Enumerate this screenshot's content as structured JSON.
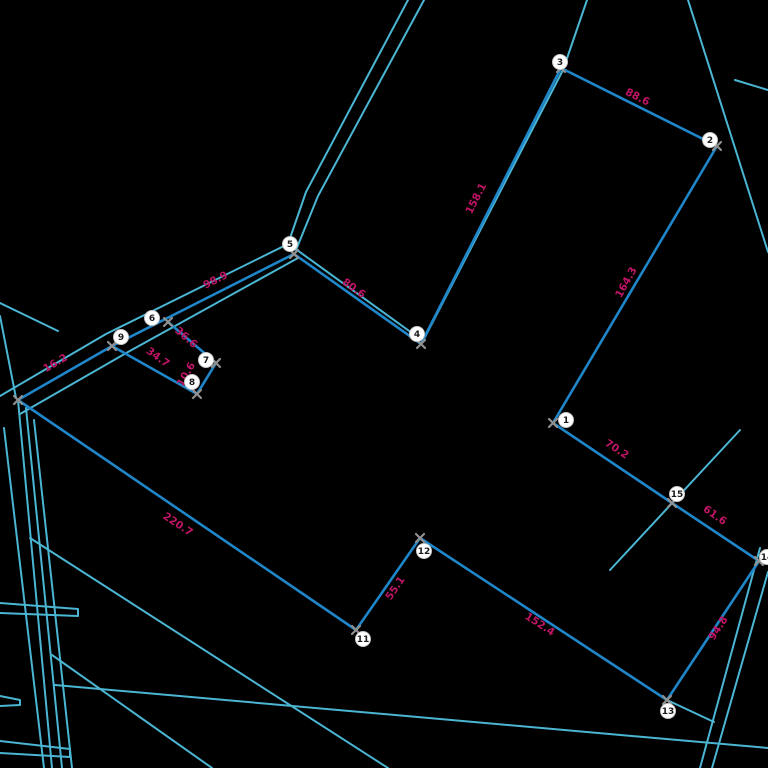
{
  "canvas": {
    "width": 768,
    "height": 768,
    "background": "#000000"
  },
  "style": {
    "boundary_color": "#1f86c9",
    "road_color": "#4bb6d3",
    "label_color": "#c01566",
    "marker_color": "#909090",
    "point_fill": "#ffffff",
    "point_stroke": "#c8c8c8",
    "point_text": "#1a1a1a",
    "boundary_width": 2.6,
    "road_width": 2
  },
  "points": [
    {
      "n": "1",
      "x": 566,
      "y": 420
    },
    {
      "n": "2",
      "x": 710,
      "y": 140
    },
    {
      "n": "3",
      "x": 560,
      "y": 62
    },
    {
      "n": "4",
      "x": 417,
      "y": 334
    },
    {
      "n": "5",
      "x": 290,
      "y": 244
    },
    {
      "n": "6",
      "x": 152,
      "y": 318
    },
    {
      "n": "7",
      "x": 206,
      "y": 360
    },
    {
      "n": "8",
      "x": 192,
      "y": 382
    },
    {
      "n": "9",
      "x": 121,
      "y": 337
    },
    {
      "n": "11",
      "x": 363,
      "y": 639
    },
    {
      "n": "12",
      "x": 424,
      "y": 551
    },
    {
      "n": "13",
      "x": 668,
      "y": 711
    },
    {
      "n": "14",
      "x": 767,
      "y": 557
    },
    {
      "n": "15",
      "x": 677,
      "y": 494
    }
  ],
  "markers": [
    [
      561,
      68
    ],
    [
      717,
      146
    ],
    [
      553,
      423
    ],
    [
      421,
      344
    ],
    [
      294,
      254
    ],
    [
      168,
      322
    ],
    [
      216,
      363
    ],
    [
      197,
      394
    ],
    [
      112,
      346
    ],
    [
      18,
      400
    ],
    [
      356,
      630
    ],
    [
      420,
      538
    ],
    [
      667,
      700
    ],
    [
      759,
      561
    ],
    [
      672,
      503
    ]
  ],
  "boundary": [
    {
      "id": "3-2",
      "from": [
        561,
        68
      ],
      "to": [
        717,
        146
      ],
      "label": "88.6",
      "lx": 636,
      "ly": 100,
      "angle": 27
    },
    {
      "id": "2-1",
      "from": [
        717,
        146
      ],
      "to": [
        553,
        423
      ],
      "label": "164.3",
      "lx": 629,
      "ly": 284,
      "angle": -61
    },
    {
      "id": "3-4",
      "from": [
        561,
        68
      ],
      "to": [
        421,
        344
      ],
      "label": "158.1",
      "lx": 479,
      "ly": 200,
      "angle": -63
    },
    {
      "id": "5-4",
      "from": [
        294,
        254
      ],
      "to": [
        421,
        344
      ],
      "label": "80.6",
      "lx": 352,
      "ly": 291,
      "angle": 36
    },
    {
      "id": "9-5",
      "from": [
        112,
        346
      ],
      "to": [
        294,
        254
      ],
      "label": "98.9",
      "lx": 217,
      "ly": 283,
      "angle": -27
    },
    {
      "id": "10-9",
      "from": [
        18,
        400
      ],
      "to": [
        112,
        346
      ],
      "label": "16.2",
      "lx": 57,
      "ly": 366,
      "angle": -30
    },
    {
      "id": "10-11",
      "from": [
        18,
        400
      ],
      "to": [
        356,
        630
      ],
      "label": "220.7",
      "lx": 176,
      "ly": 527,
      "angle": 34
    },
    {
      "id": "11-12",
      "from": [
        356,
        630
      ],
      "to": [
        420,
        538
      ],
      "label": "55.1",
      "lx": 398,
      "ly": 590,
      "angle": -56
    },
    {
      "id": "12-13",
      "from": [
        420,
        538
      ],
      "to": [
        667,
        700
      ],
      "label": "152.4",
      "lx": 538,
      "ly": 627,
      "angle": 33
    },
    {
      "id": "13-14",
      "from": [
        667,
        700
      ],
      "to": [
        759,
        561
      ],
      "label": "94.8",
      "lx": 721,
      "ly": 630,
      "angle": -57
    },
    {
      "id": "15-14",
      "from": [
        672,
        503
      ],
      "to": [
        759,
        561
      ],
      "label": "61.6",
      "lx": 713,
      "ly": 518,
      "angle": 35
    },
    {
      "id": "1-15",
      "from": [
        553,
        423
      ],
      "to": [
        672,
        503
      ],
      "label": "70.2",
      "lx": 615,
      "ly": 452,
      "angle": 33
    },
    {
      "id": "6-7",
      "from": [
        168,
        322
      ],
      "to": [
        216,
        363
      ],
      "label": "36.6",
      "lx": 184,
      "ly": 340,
      "angle": 41
    },
    {
      "id": "7-8",
      "from": [
        216,
        363
      ],
      "to": [
        197,
        394
      ],
      "label": "10.6",
      "lx": 189,
      "ly": 376,
      "angle": -60
    },
    {
      "id": "9-8",
      "from": [
        112,
        346
      ],
      "to": [
        197,
        394
      ],
      "label": "34.7",
      "lx": 156,
      "ly": 360,
      "angle": 36
    }
  ],
  "roads": [
    {
      "name": "road-top-edge-a",
      "pts": [
        [
          424,
          0
        ],
        [
          318,
          196
        ],
        [
          296,
          250
        ]
      ]
    },
    {
      "name": "road-top-edge-b",
      "pts": [
        [
          408,
          0
        ],
        [
          306,
          192
        ],
        [
          288,
          244
        ],
        [
          106,
          334
        ],
        [
          0,
          396
        ]
      ]
    },
    {
      "name": "road-corridor-lower",
      "pts": [
        [
          298,
          258
        ],
        [
          128,
          352
        ],
        [
          20,
          414
        ]
      ]
    },
    {
      "name": "road-along-3-4-5",
      "pts": [
        [
          587,
          0
        ],
        [
          563,
          70
        ],
        [
          423,
          341
        ],
        [
          297,
          250
        ]
      ]
    },
    {
      "name": "road-northeast",
      "pts": [
        [
          688,
          0
        ],
        [
          768,
          252
        ]
      ]
    },
    {
      "name": "road-northeast-stub",
      "pts": [
        [
          735,
          80
        ],
        [
          768,
          90
        ]
      ]
    },
    {
      "name": "road-through-15",
      "pts": [
        [
          740,
          430
        ],
        [
          610,
          570
        ]
      ]
    },
    {
      "name": "road-southeast-a",
      "pts": [
        [
          760,
          548
        ],
        [
          700,
          768
        ]
      ]
    },
    {
      "name": "road-southeast-b",
      "pts": [
        [
          768,
          572
        ],
        [
          712,
          768
        ]
      ]
    },
    {
      "name": "road-13-stub",
      "pts": [
        [
          667,
          700
        ],
        [
          714,
          722
        ]
      ]
    },
    {
      "name": "road-west-fan-1",
      "pts": [
        [
          18,
          400
        ],
        [
          52,
          768
        ]
      ]
    },
    {
      "name": "road-west-fan-2",
      "pts": [
        [
          26,
          408
        ],
        [
          62,
          768
        ]
      ]
    },
    {
      "name": "road-west-fan-3",
      "pts": [
        [
          34,
          420
        ],
        [
          72,
          768
        ]
      ]
    },
    {
      "name": "road-west-fan-4",
      "pts": [
        [
          4,
          428
        ],
        [
          44,
          768
        ]
      ]
    },
    {
      "name": "road-west-edge",
      "pts": [
        [
          0,
          316
        ],
        [
          16,
          398
        ]
      ]
    },
    {
      "name": "road-west-branch",
      "pts": [
        [
          0,
          303
        ],
        [
          58,
          331
        ]
      ]
    },
    {
      "name": "road-diagonal-1",
      "pts": [
        [
          30,
          538
        ],
        [
          388,
          768
        ]
      ]
    },
    {
      "name": "road-diagonal-2",
      "pts": [
        [
          52,
          655
        ],
        [
          212,
          768
        ]
      ]
    },
    {
      "name": "road-diagonal-3",
      "pts": [
        [
          55,
          685
        ],
        [
          768,
          748
        ]
      ]
    },
    {
      "name": "road-edge-stub-1",
      "pts": [
        [
          0,
          603
        ],
        [
          78,
          609
        ],
        [
          78,
          616
        ],
        [
          0,
          613
        ]
      ]
    },
    {
      "name": "road-edge-stub-2",
      "pts": [
        [
          0,
          696
        ],
        [
          20,
          700
        ],
        [
          20,
          705
        ],
        [
          0,
          706
        ]
      ]
    },
    {
      "name": "road-edge-stub-3",
      "pts": [
        [
          0,
          741
        ],
        [
          70,
          749
        ],
        [
          70,
          757
        ],
        [
          0,
          753
        ]
      ]
    }
  ]
}
